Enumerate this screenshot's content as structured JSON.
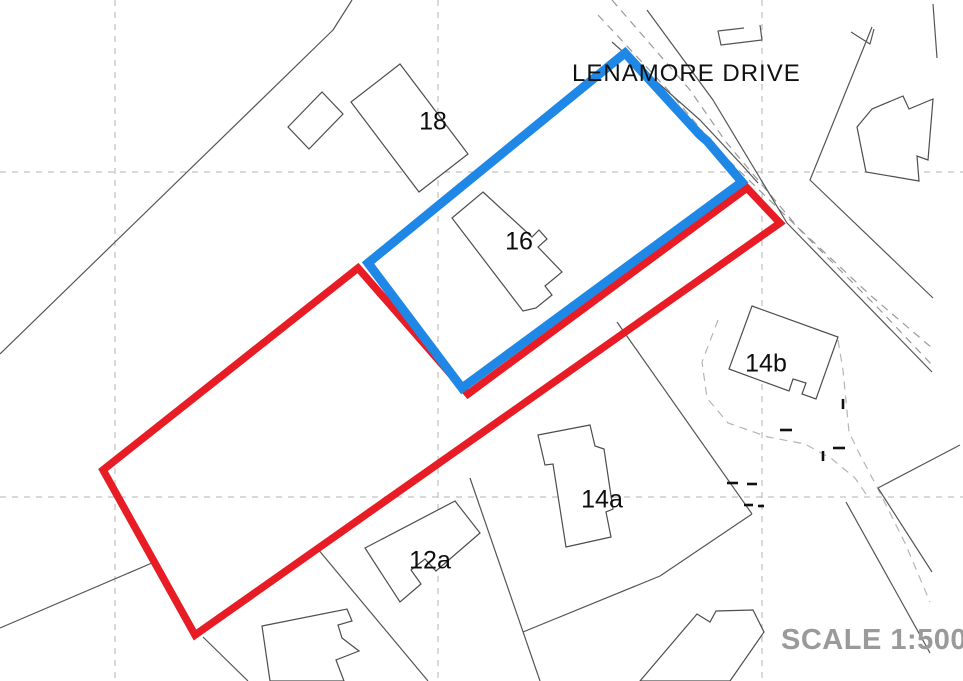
{
  "street": {
    "label": "LENAMORE DRIVE"
  },
  "scale": {
    "label": "SCALE 1:500"
  },
  "colors": {
    "boundary_red": "#e81c24",
    "boundary_blue": "#1f87e5",
    "house_stroke": "#4d4d4d",
    "thin_line": "#555555",
    "grid_line": "#b3b3b3",
    "garden_dash": "#b5b5b5",
    "road_dash": "#9a9a9a",
    "tick": "#111111",
    "label_text": "#0d0d0d"
  },
  "style": {
    "blue_width": 9,
    "red_width": 7.5,
    "thin_width": 1.2,
    "house_width": 1.2,
    "grid_width": 1,
    "tick_width": 2.6,
    "label_font_size": 25
  },
  "grid": {
    "vertical_x": [
      115,
      438,
      762
    ],
    "horizontal_y": [
      172,
      497
    ]
  },
  "boundaries": {
    "red_outline": {
      "name": "red-application-boundary",
      "closed": true,
      "points": [
        [
          358,
          268
        ],
        [
          468,
          394
        ],
        [
          747,
          188
        ],
        [
          780,
          223
        ],
        [
          195,
          635
        ],
        [
          103,
          470
        ]
      ]
    },
    "blue_outline": {
      "name": "blue-site-boundary",
      "closed": true,
      "points": [
        [
          625,
          53
        ],
        [
          700,
          135
        ],
        [
          707,
          141
        ],
        [
          742,
          182
        ],
        [
          462,
          388
        ],
        [
          368,
          263
        ]
      ]
    }
  },
  "houses": [
    {
      "name": "house-18-garage",
      "closed": true,
      "points": [
        [
          288,
          127
        ],
        [
          322,
          92
        ],
        [
          343,
          114
        ],
        [
          309,
          149
        ]
      ]
    },
    {
      "name": "house-18-main",
      "closed": true,
      "points": [
        [
          400,
          64
        ],
        [
          468,
          154
        ],
        [
          419,
          192
        ],
        [
          351,
          102
        ]
      ]
    },
    {
      "name": "house-16",
      "closed": true,
      "points": [
        [
          483,
          192
        ],
        [
          532,
          237
        ],
        [
          539,
          230
        ],
        [
          547,
          239
        ],
        [
          538,
          247
        ],
        [
          562,
          272
        ],
        [
          545,
          286
        ],
        [
          552,
          295
        ],
        [
          536,
          308
        ],
        [
          523,
          311
        ],
        [
          452,
          218
        ]
      ]
    },
    {
      "name": "house-14b",
      "closed": true,
      "points": [
        [
          752,
          306
        ],
        [
          838,
          337
        ],
        [
          816,
          399
        ],
        [
          802,
          394
        ],
        [
          806,
          383
        ],
        [
          793,
          379
        ],
        [
          789,
          391
        ],
        [
          729,
          369
        ]
      ]
    },
    {
      "name": "house-14a",
      "closed": true,
      "points": [
        [
          538,
          435
        ],
        [
          590,
          425
        ],
        [
          595,
          446
        ],
        [
          604,
          449
        ],
        [
          613,
          509
        ],
        [
          606,
          512
        ],
        [
          611,
          537
        ],
        [
          566,
          547
        ],
        [
          553,
          464
        ],
        [
          545,
          465
        ]
      ]
    },
    {
      "name": "house-12a",
      "closed": true,
      "points": [
        [
          365,
          548
        ],
        [
          455,
          501
        ],
        [
          480,
          533
        ],
        [
          436,
          571
        ],
        [
          425,
          559
        ],
        [
          411,
          570
        ],
        [
          421,
          584
        ],
        [
          400,
          602
        ]
      ]
    },
    {
      "name": "house-bottom-left",
      "closed": true,
      "points": [
        [
          262,
          626
        ],
        [
          347,
          609
        ],
        [
          352,
          621
        ],
        [
          338,
          625
        ],
        [
          342,
          638
        ],
        [
          359,
          651
        ],
        [
          336,
          660
        ],
        [
          344,
          681
        ],
        [
          270,
          681
        ]
      ]
    },
    {
      "name": "house-bottom-right",
      "closed": true,
      "points": [
        [
          640,
          681
        ],
        [
          697,
          614
        ],
        [
          710,
          622
        ],
        [
          716,
          611
        ],
        [
          753,
          610
        ],
        [
          764,
          632
        ],
        [
          730,
          681
        ]
      ]
    },
    {
      "name": "house-top-right",
      "closed": true,
      "points": [
        [
          857,
          127
        ],
        [
          872,
          109
        ],
        [
          903,
          96
        ],
        [
          909,
          109
        ],
        [
          933,
          99
        ],
        [
          928,
          160
        ],
        [
          917,
          156
        ],
        [
          919,
          181
        ],
        [
          866,
          172
        ]
      ]
    }
  ],
  "thin_lines": [
    {
      "name": "field-line-left-diagonal",
      "points": [
        [
          0,
          354
        ],
        [
          333,
          30
        ],
        [
          352,
          0
        ]
      ]
    },
    {
      "name": "road-line-upper-v",
      "points": [
        [
          872,
          27
        ],
        [
          810,
          180
        ],
        [
          933,
          298
        ]
      ]
    },
    {
      "name": "road-edge-sw",
      "points": [
        [
          647,
          10
        ],
        [
          713,
          100
        ],
        [
          787,
          223
        ],
        [
          932,
          372
        ]
      ]
    },
    {
      "name": "road-edge-inner",
      "points": [
        [
          612,
          42
        ],
        [
          700,
          120
        ],
        [
          742,
          165
        ],
        [
          758,
          183
        ]
      ]
    },
    {
      "name": "road-stub-top-right",
      "points": [
        [
          933,
          4
        ],
        [
          937,
          58
        ]
      ]
    },
    {
      "name": "fence-stub-top-right",
      "points": [
        [
          851,
          32
        ],
        [
          870,
          44
        ],
        [
          874,
          29
        ]
      ]
    },
    {
      "name": "fence-14a-14b",
      "points": [
        [
          617,
          322
        ],
        [
          752,
          514
        ]
      ]
    },
    {
      "name": "fence-below-14a",
      "points": [
        [
          752,
          514
        ],
        [
          660,
          576
        ],
        [
          523,
          632
        ]
      ]
    },
    {
      "name": "fence-right-upper",
      "points": [
        [
          878,
          488
        ],
        [
          960,
          445
        ]
      ]
    },
    {
      "name": "fence-right-mid",
      "points": [
        [
          878,
          488
        ],
        [
          932,
          572
        ]
      ]
    },
    {
      "name": "fence-right-long",
      "points": [
        [
          846,
          502
        ],
        [
          930,
          653
        ]
      ]
    },
    {
      "name": "fence-bottom-left",
      "points": [
        [
          0,
          628
        ],
        [
          152,
          563
        ]
      ]
    },
    {
      "name": "fence-below-red-corner",
      "points": [
        [
          203,
          637
        ],
        [
          248,
          681
        ]
      ]
    },
    {
      "name": "fence-12a-west",
      "points": [
        [
          317,
          548
        ],
        [
          428,
          681
        ]
      ]
    },
    {
      "name": "fence-12a-east",
      "points": [
        [
          470,
          478
        ],
        [
          540,
          681
        ]
      ]
    },
    {
      "name": "outbuilding-top",
      "points": [
        [
          744,
          28
        ],
        [
          718,
          31
        ],
        [
          721,
          45
        ],
        [
          762,
          40
        ],
        [
          760,
          25
        ]
      ]
    },
    {
      "name": "house-bottom-left-wall",
      "points": [
        [
          269,
          627
        ],
        [
          276,
          681
        ]
      ]
    }
  ],
  "dashed_lines": [
    {
      "name": "garden-dash-14b",
      "kind": "garden",
      "points": [
        [
          718,
          320
        ],
        [
          702,
          362
        ],
        [
          707,
          398
        ],
        [
          728,
          423
        ],
        [
          768,
          437
        ],
        [
          805,
          444
        ],
        [
          832,
          459
        ],
        [
          855,
          478
        ],
        [
          868,
          497
        ]
      ]
    },
    {
      "name": "garden-dash-right",
      "kind": "garden",
      "points": [
        [
          838,
          340
        ],
        [
          843,
          370
        ],
        [
          849,
          432
        ],
        [
          858,
          451
        ],
        [
          877,
          487
        ],
        [
          905,
          543
        ],
        [
          930,
          602
        ]
      ]
    },
    {
      "name": "road-centre-dash-1",
      "kind": "road",
      "points": [
        [
          598,
          15
        ],
        [
          668,
          90
        ],
        [
          718,
          150
        ],
        [
          790,
          220
        ],
        [
          870,
          295
        ],
        [
          932,
          348
        ]
      ]
    },
    {
      "name": "road-centre-dash-2",
      "kind": "road",
      "points": [
        [
          612,
          0
        ],
        [
          690,
          90
        ],
        [
          726,
          142
        ],
        [
          800,
          230
        ],
        [
          880,
          310
        ],
        [
          932,
          365
        ]
      ]
    }
  ],
  "ticks": [
    {
      "name": "boundary-tick",
      "points": [
        [
          727,
          483
        ],
        [
          738,
          483
        ]
      ]
    },
    {
      "name": "boundary-tick",
      "points": [
        [
          747,
          484
        ],
        [
          757,
          484
        ]
      ]
    },
    {
      "name": "boundary-tick",
      "points": [
        [
          744,
          505
        ],
        [
          753,
          505
        ]
      ]
    },
    {
      "name": "boundary-tick",
      "points": [
        [
          758,
          506
        ],
        [
          764,
          506
        ]
      ]
    },
    {
      "name": "boundary-tick",
      "points": [
        [
          843,
          399
        ],
        [
          843,
          409
        ]
      ]
    },
    {
      "name": "boundary-tick",
      "points": [
        [
          823,
          451
        ],
        [
          823,
          461
        ]
      ]
    },
    {
      "name": "boundary-tick",
      "points": [
        [
          833,
          448
        ],
        [
          845,
          448
        ]
      ]
    },
    {
      "name": "boundary-tick",
      "points": [
        [
          780,
          430
        ],
        [
          792,
          430
        ]
      ]
    }
  ],
  "house_labels": [
    {
      "text": "18",
      "x": 433,
      "y": 123
    },
    {
      "text": "16",
      "x": 519,
      "y": 243
    },
    {
      "text": "14b",
      "x": 766,
      "y": 365
    },
    {
      "text": "14a",
      "x": 602,
      "y": 501
    },
    {
      "text": "12a",
      "x": 430,
      "y": 562
    }
  ]
}
